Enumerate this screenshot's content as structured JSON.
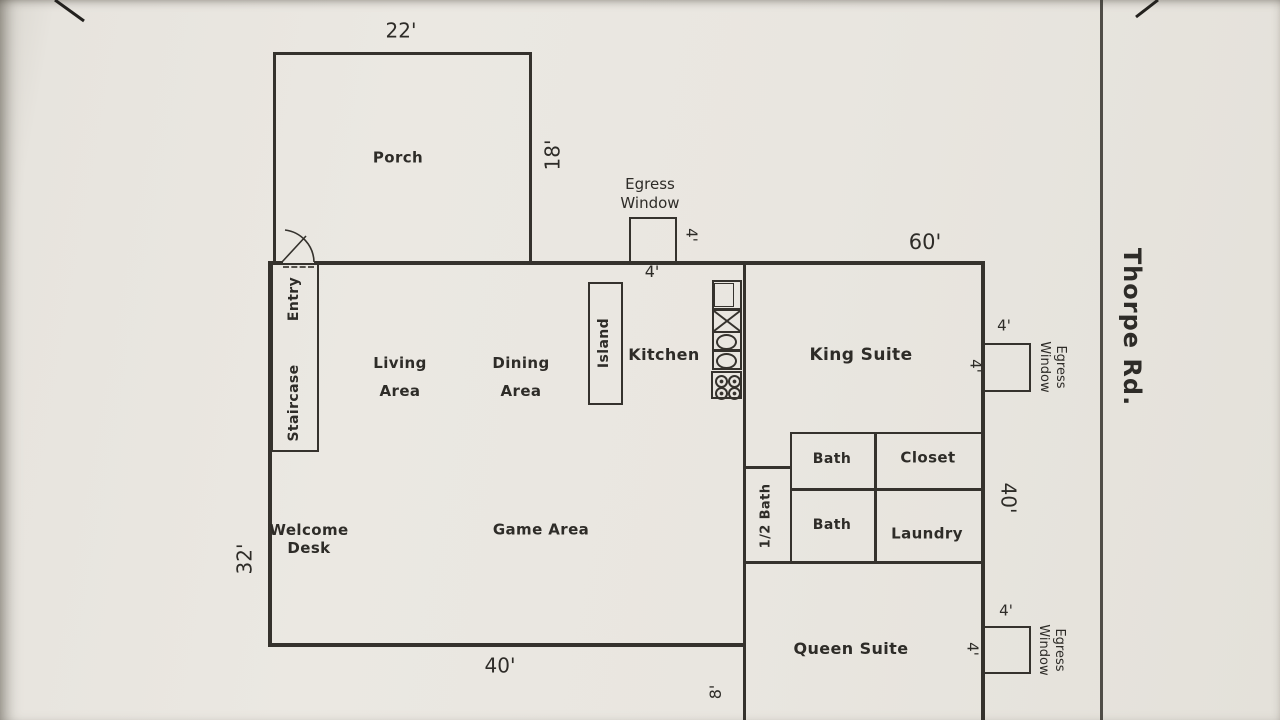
{
  "road": {
    "label": "Thorpe Rd."
  },
  "rooms": {
    "porch": "Porch",
    "entry": "Entry",
    "staircase": "Staircase",
    "living_1": "Living",
    "living_2": "Area",
    "dining_1": "Dining",
    "dining_2": "Area",
    "island": "Island",
    "kitchen": "Kitchen",
    "king_suite": "King Suite",
    "bath_top": "Bath",
    "closet": "Closet",
    "bath_bottom": "Bath",
    "laundry": "Laundry",
    "half_bath": "1/2 Bath",
    "welcome_1": "Welcome",
    "welcome_2": "Desk",
    "game_area": "Game Area",
    "queen_suite": "Queen Suite"
  },
  "windows": {
    "top": {
      "line1": "Egress",
      "line2": "Window",
      "width": "4'",
      "depth": "4'"
    },
    "king": {
      "line1": "Egress",
      "line2": "Window",
      "width": "4'",
      "depth": "4'"
    },
    "queen": {
      "line1": "Egress",
      "line2": "Window",
      "width": "4'",
      "depth": "4'"
    }
  },
  "dimensions": {
    "porch_width": "22'",
    "porch_depth": "18'",
    "main_top_width": "60'",
    "left_height": "32'",
    "bottom_width": "40'",
    "right_height": "40'",
    "queen_side_offset": "8'"
  }
}
